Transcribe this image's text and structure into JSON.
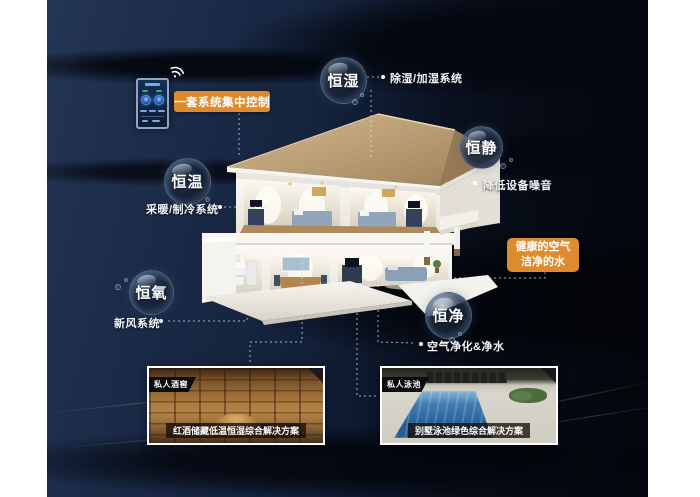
{
  "poster": {
    "control_tag": "一套系统集中控制",
    "highlight_box": {
      "line1": "健康的空气",
      "line2": "洁净的水"
    },
    "bubbles": [
      {
        "label": "恒湿",
        "desc": "除湿/加湿系统"
      },
      {
        "label": "恒静",
        "desc": "降低设备噪音"
      },
      {
        "label": "恒温",
        "desc": "采暖/制冷系统"
      },
      {
        "label": "恒氧",
        "desc": "新风系统"
      },
      {
        "label": "恒净",
        "desc": "空气净化&净水"
      }
    ],
    "cards": [
      {
        "tag": "私人酒窖",
        "caption": "红酒储藏低温恒湿综合解决方案"
      },
      {
        "tag": "私人泳池",
        "caption": "别墅泳池绿色综合解决方案"
      }
    ],
    "colors": {
      "accent_orange": "#DE8B30",
      "panel_navy": "#17263F",
      "label_text": "#F2F4F7"
    }
  }
}
